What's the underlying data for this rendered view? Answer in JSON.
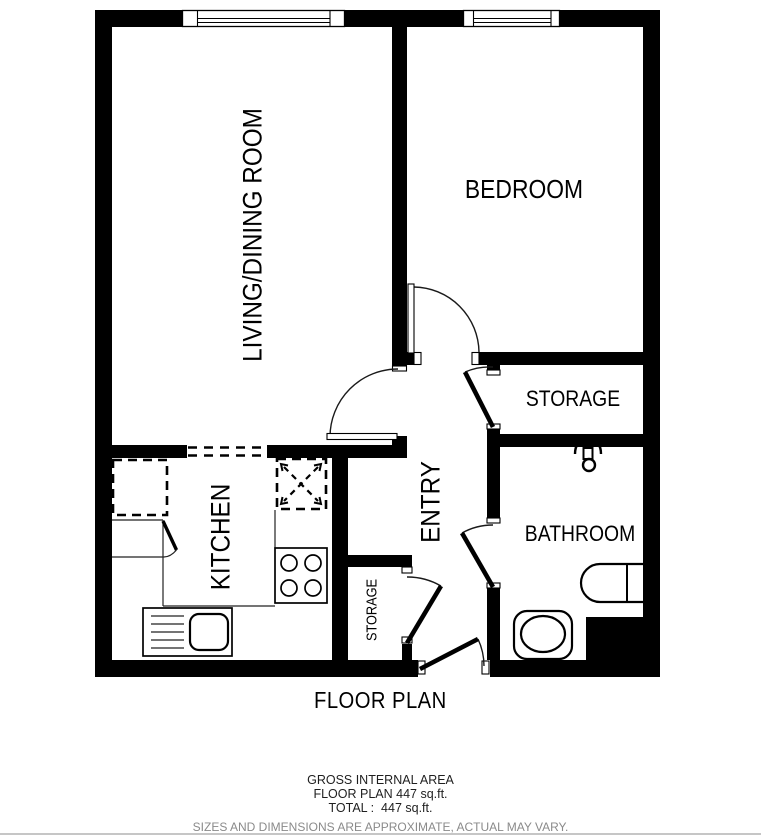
{
  "title": "FLOOR PLAN",
  "rooms": {
    "living": {
      "label": "LIVING/DINING ROOM",
      "orientation": "vertical"
    },
    "bedroom": {
      "label": "BEDROOM",
      "orientation": "horizontal"
    },
    "storage_right": {
      "label": "STORAGE",
      "orientation": "horizontal"
    },
    "bathroom": {
      "label": "BATHROOM",
      "orientation": "horizontal"
    },
    "entry": {
      "label": "ENTRY",
      "orientation": "vertical"
    },
    "kitchen": {
      "label": "KITCHEN",
      "orientation": "vertical"
    },
    "storage_small": {
      "label": "STORAGE",
      "orientation": "vertical"
    }
  },
  "fixtures": {
    "bathroom": [
      "shower-head",
      "toilet",
      "sink"
    ],
    "kitchen": [
      "dashed-appliance",
      "crossed-appliance",
      "stove-4-burner",
      "sink-with-drainer",
      "counter"
    ],
    "windows": 2,
    "doors": [
      "living-room-door",
      "bedroom-door",
      "storage-door",
      "bathroom-door",
      "closet-door",
      "front-door"
    ]
  },
  "areas": {
    "floor_plan_sqft": 447,
    "total_sqft": 447,
    "units": "sq.ft."
  },
  "footer": {
    "line1": "GROSS INTERNAL AREA",
    "line2": "FLOOR PLAN 447 sq.ft.",
    "line3": "TOTAL :  447 sq.ft.",
    "disclaimer": "SIZES AND DIMENSIONS ARE APPROXIMATE, ACTUAL MAY VARY."
  },
  "colors": {
    "wall": "#000000",
    "background": "#ffffff",
    "label": "#000000",
    "disclaimer_text": "#8a8a8a",
    "bottom_divider": "#c6c6c6"
  }
}
